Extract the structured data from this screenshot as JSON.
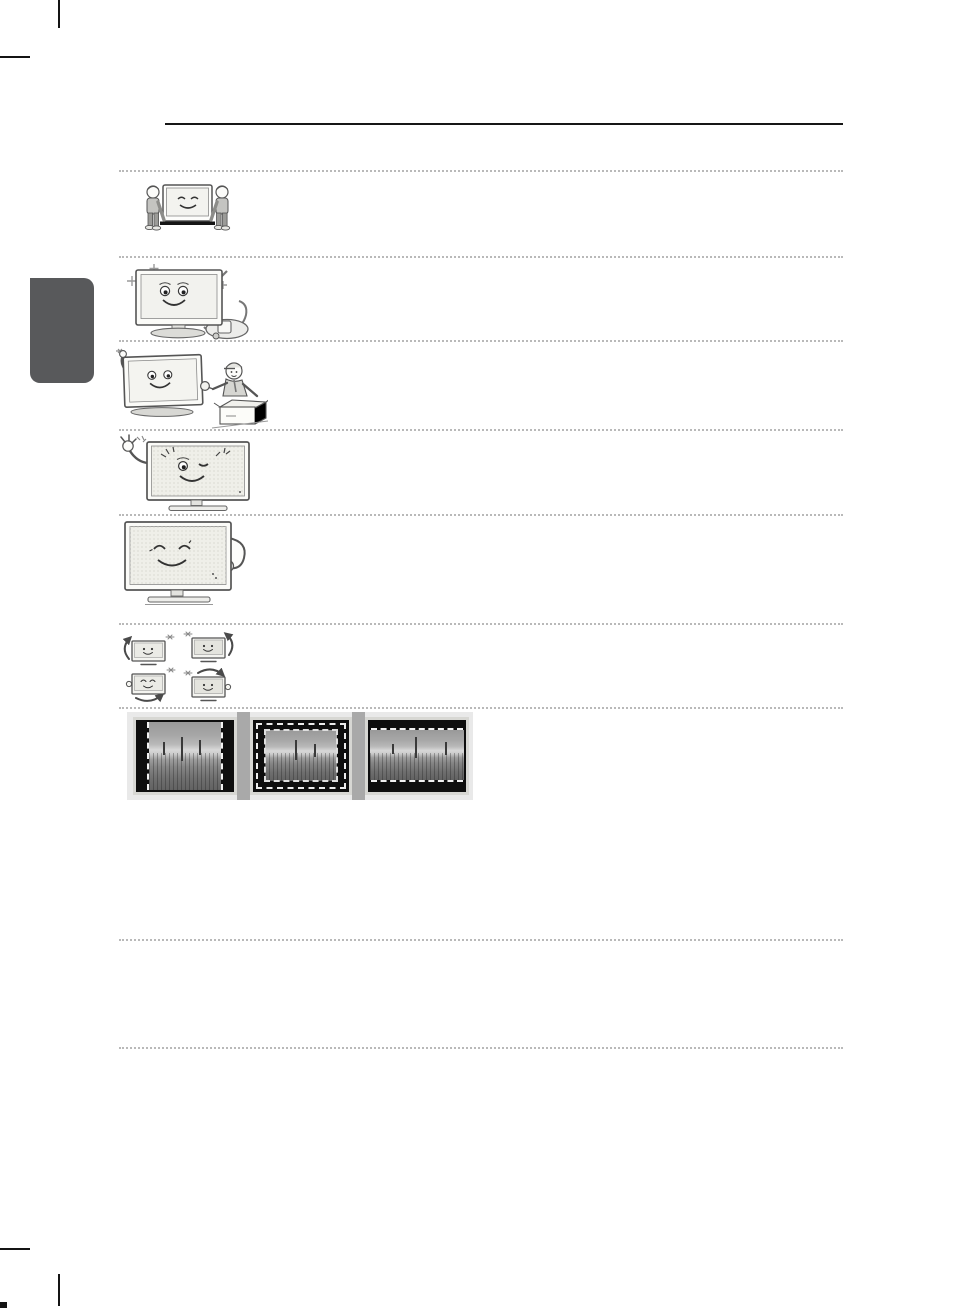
{
  "page": {
    "kind": "tv-manual-illustration-page"
  },
  "colors": {
    "chapter_tab": "#58595b",
    "top_rule": "#161616",
    "dotted_separator": "#b9b9b9",
    "strip_background": "#e9e9e9",
    "strip_gap": "#a9a9a9",
    "photo_frame": "#d7d7d3",
    "photo_black_bar": "#0e0e0e"
  },
  "illustrations": [
    {
      "name": "two-people-carrying-tv"
    },
    {
      "name": "sparkling-tv-with-vacuum-cleaner"
    },
    {
      "name": "tv-waving-with-service-technician-and-open-box"
    },
    {
      "name": "winking-tv-with-finger-snap"
    },
    {
      "name": "relaxed-tv-patting-its-side"
    },
    {
      "name": "four-small-tvs-with-rotation-arrows"
    }
  ],
  "screen_examples": [
    {
      "name": "pillarbox-4-3-image-with-dashed-guides"
    },
    {
      "name": "windowboxed-image-with-dashed-guides"
    },
    {
      "name": "letterbox-16-9-image-with-dashed-guides"
    }
  ]
}
